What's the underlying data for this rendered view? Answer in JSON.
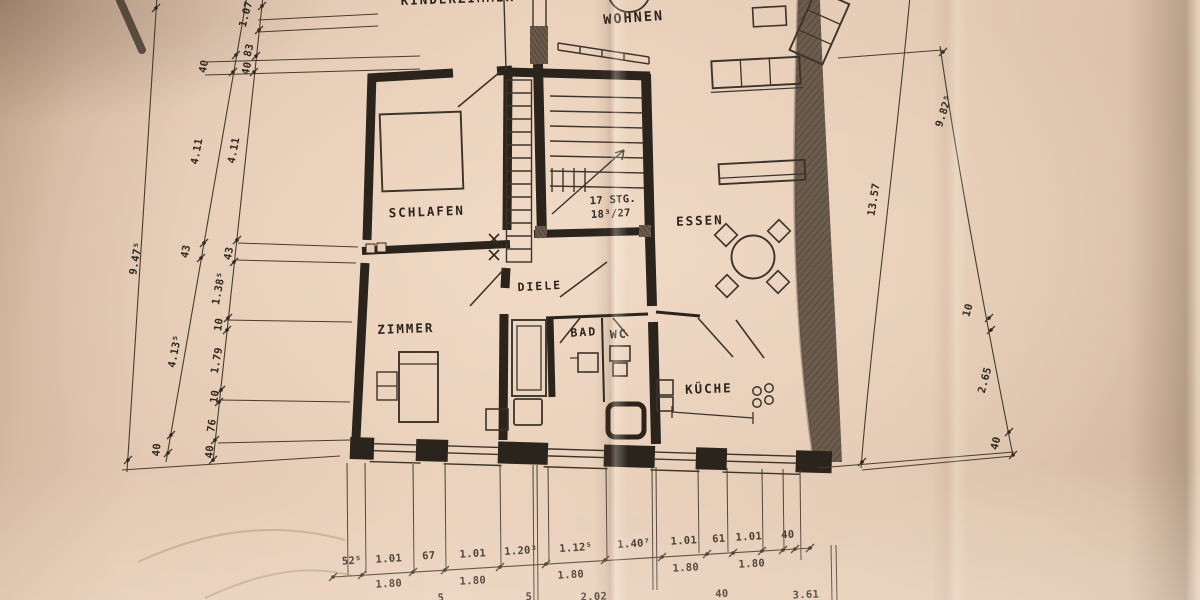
{
  "document_type": "hand-drawn apartment floor plan (photo of paper drawing)",
  "colors": {
    "paper": "#e6cdb8",
    "ink": "#2b241d",
    "pencil_boundary": "#55483a",
    "thin_line": "#473c30"
  },
  "rooms": {
    "wohnen": "WOHNEN",
    "schlafen": "SCHLAFEN",
    "essen": "ESSEN",
    "diele": "DIELE",
    "zimmer": "ZIMMER",
    "bad": "BAD",
    "wc": "WC",
    "kueche": "KÜCHE",
    "top_clipped": "KINDERZIMMER"
  },
  "stairs": {
    "count": "17 STG.",
    "ratio": "18³/27"
  },
  "dimensions": {
    "left_total": "9.47⁵",
    "left_main": [
      "40",
      "4.11",
      "43",
      "4.13⁵",
      "40"
    ],
    "left_detail": [
      "1.07",
      "83",
      "40",
      "4.11",
      "43",
      "1.38⁵",
      "10",
      "1.79",
      "10",
      "76",
      "40"
    ],
    "right_total": "13.57",
    "right_outer": [
      "9.82⁵",
      "10",
      "2.65",
      "40"
    ],
    "bottom_detail": [
      "52⁵",
      "1.01",
      "67",
      "1.01",
      "1.20³",
      "1.12⁵",
      "1.40⁷",
      "1.01",
      "61",
      "1.01",
      "40"
    ],
    "bottom_mid": [
      "1.80",
      "1.80",
      "1.80",
      "1.80",
      "1.80"
    ],
    "bottom_lower": [
      "5",
      "5",
      "2.02",
      "40",
      "3.61"
    ]
  }
}
